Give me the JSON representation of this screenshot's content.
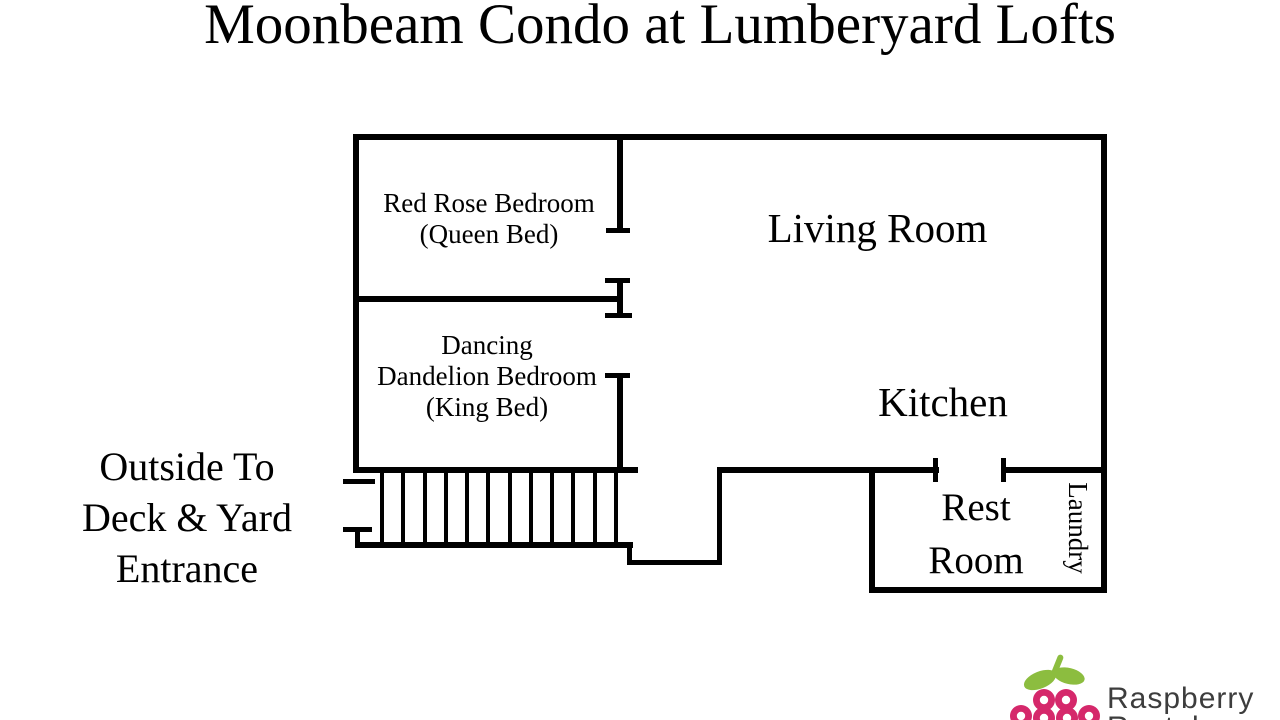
{
  "title": "Moonbeam Condo at Lumberyard Lofts",
  "rooms": {
    "red_rose": {
      "line1": "Red Rose Bedroom",
      "line2": "(Queen Bed)"
    },
    "living_room": {
      "label": "Living Room"
    },
    "dancing_dandelion": {
      "line1": "Dancing",
      "line2": "Dandelion Bedroom",
      "line3": "(King Bed)"
    },
    "kitchen": {
      "label": "Kitchen"
    },
    "rest_room": {
      "line1": "Rest",
      "line2": "Room"
    },
    "laundry": {
      "label": "Laundry"
    }
  },
  "annotations": {
    "outside_entrance": {
      "line1": "Outside To",
      "line2": "Deck & Yard",
      "line3": "Entrance"
    }
  },
  "stairs": {
    "tread_count": 12
  },
  "logo": {
    "brand_line1": "Raspberry",
    "brand_line2": "Rentals",
    "berry_color": "#d5286b",
    "leaf_color": "#8cbd3f",
    "text_color": "#3d3d3d"
  },
  "colors": {
    "wall": "#000000",
    "background": "#ffffff",
    "text": "#000000"
  }
}
